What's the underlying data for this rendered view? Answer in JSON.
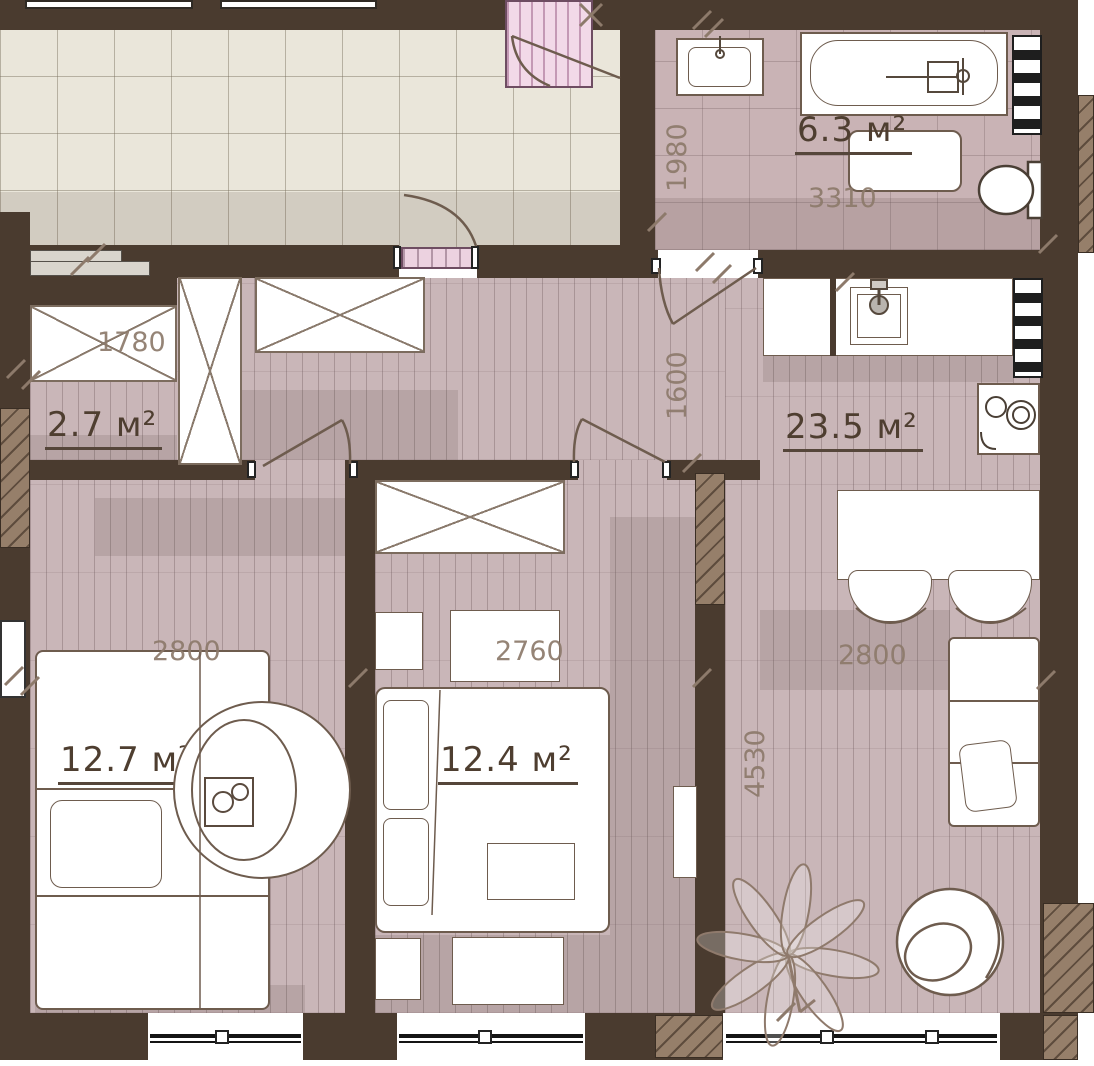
{
  "title": "apartment floor plan",
  "rooms": {
    "bathroom": {
      "area": "6.3 м²",
      "depth": "1980",
      "width": "3310"
    },
    "closet": {
      "area": "2.7 м²",
      "width": "1780"
    },
    "hallway": {
      "depth": "1600"
    },
    "kitchen_living": {
      "area": "23.5 м²",
      "width": "2800",
      "depth": "4530"
    },
    "bedroom_left": {
      "area": "12.7 м²",
      "width": "2800"
    },
    "bedroom_middle": {
      "area": "12.4 м²",
      "width": "2760"
    }
  },
  "colors": {
    "wall": "#4a3b2f",
    "plank_floor": "#c9b6b8",
    "corridor_tile": "#eae6da",
    "bath_tile": "#c9b3b5",
    "stairs_pink": "#f2d9e8",
    "area_text": "#4e3e30",
    "dim_text": "#8d7a6b",
    "furniture_outline": "#6e5c4e"
  },
  "icons": {
    "bathtub": "bathtub-icon",
    "sink": "sink-icon",
    "toilet": "toilet-icon",
    "stove": "stove-icon",
    "plant": "plant-icon"
  }
}
